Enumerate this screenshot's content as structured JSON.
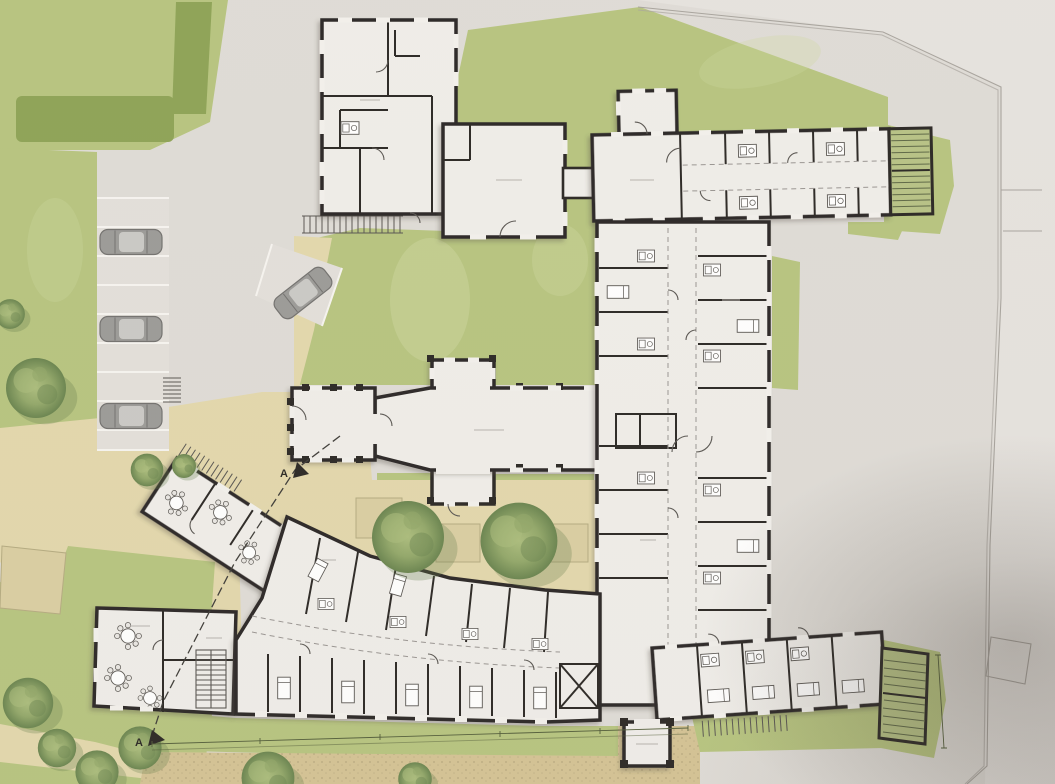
{
  "markers": {
    "section_label": "A"
  },
  "palette": {
    "paper": "#dedbd6",
    "paving_light": "#e5e2de",
    "stall": "#e2dfda",
    "lawn": "#b5c37d",
    "lawn_light": "#ced6a0",
    "hedge": "#8ba153",
    "path_tan": "#e2d7ab",
    "gravel": "#d3c292",
    "bed_tan": "#d9cda0",
    "floor": "#efede9",
    "window": "#f2f0ec",
    "wall": "#262320",
    "detail": "#55524e",
    "stair_green": "#b5c183",
    "stair_hatch": "#5a6442",
    "tree_light": "#a9bb7a",
    "tree_mid": "#8fa566",
    "tree_dark": "#66814b",
    "tree_shadow": "#5f7544",
    "car_body": "#999896",
    "car_glass": "#c9c8c5",
    "car_line": "#6f6e6c",
    "boundary": "#a6a29c",
    "white_line": "#f6f4f0",
    "dims": "#4f5a36",
    "label": "#b5b1ac"
  }
}
